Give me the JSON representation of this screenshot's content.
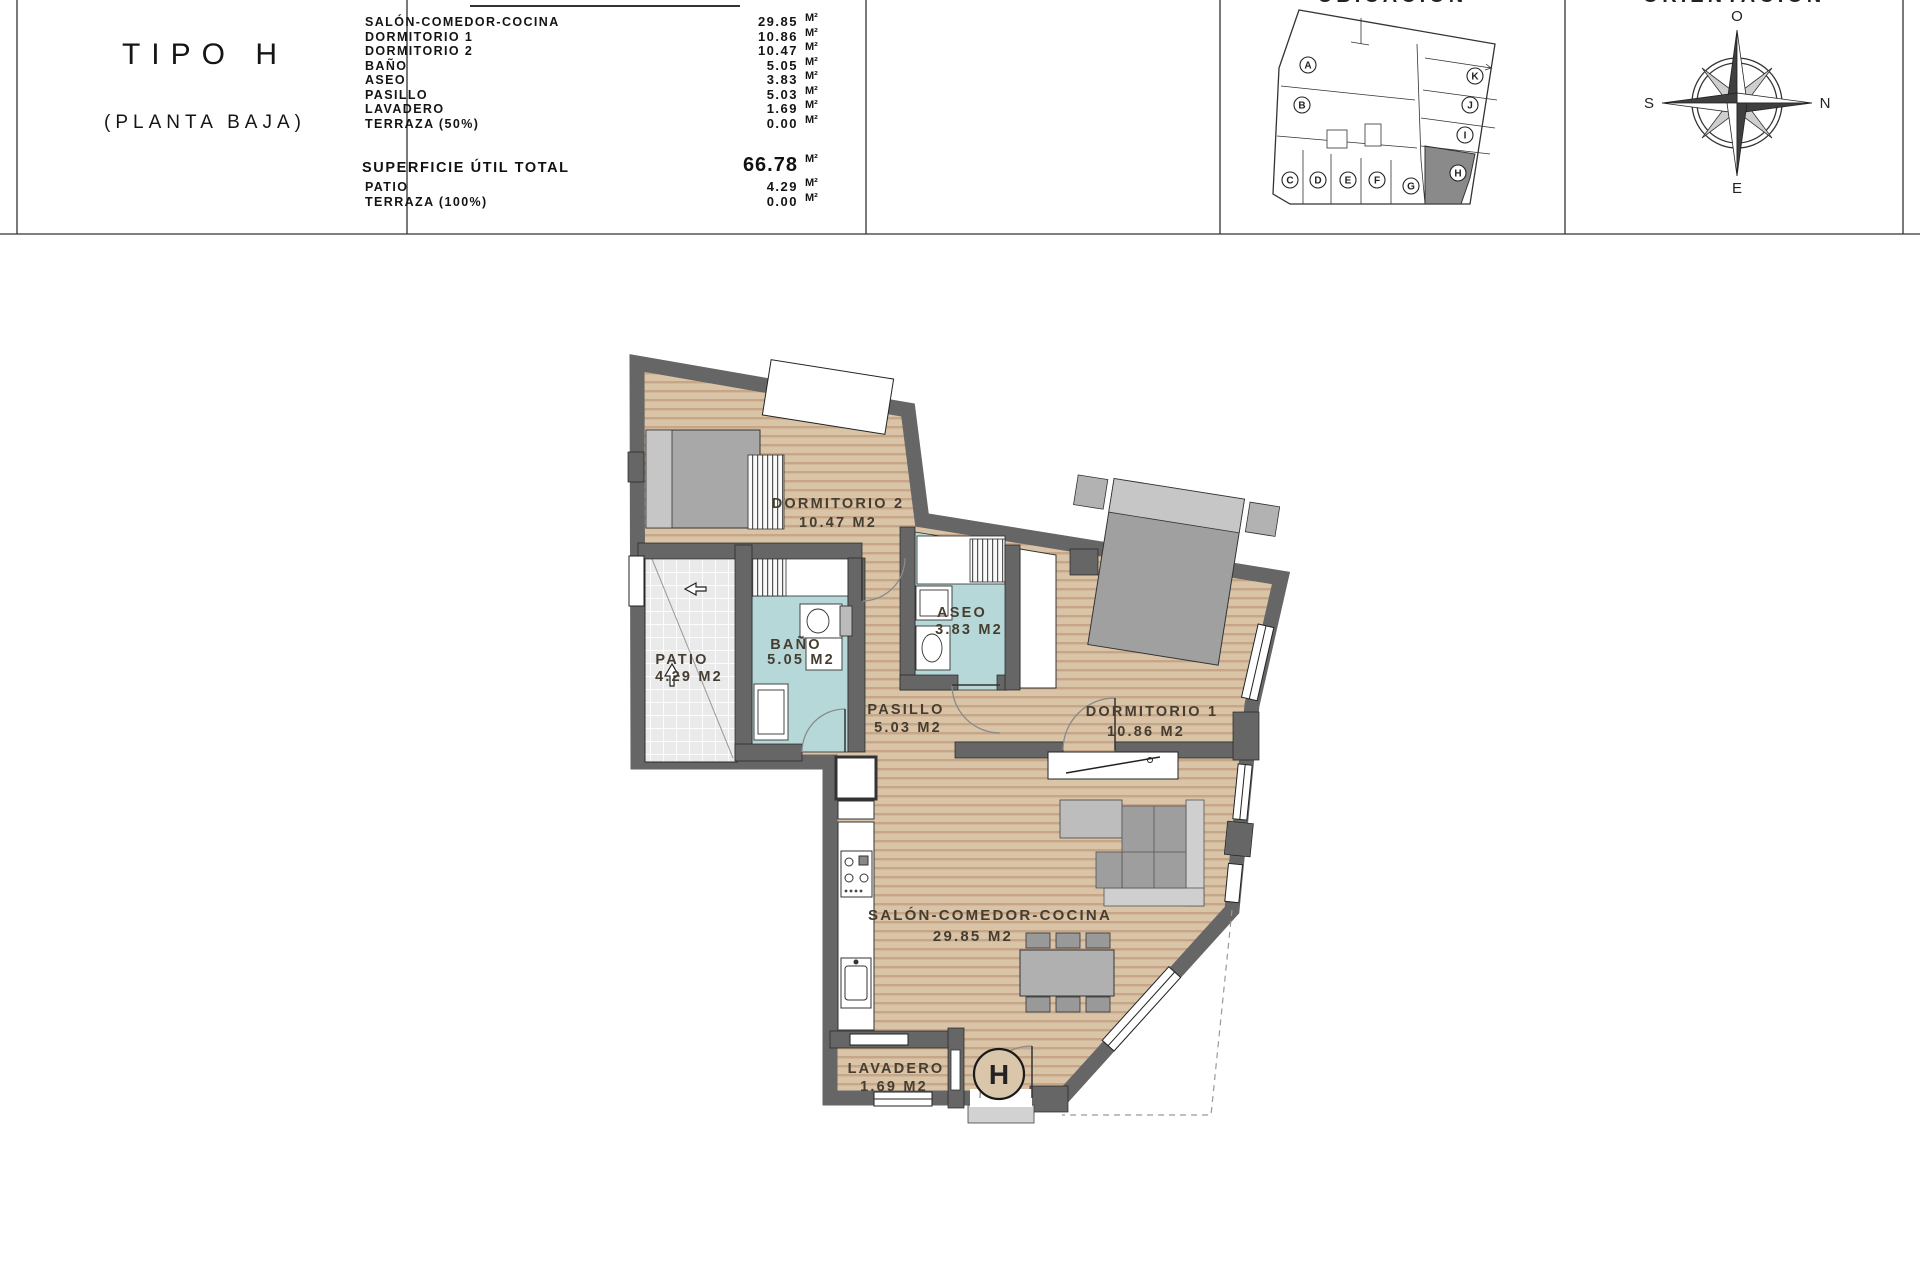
{
  "title_block": {
    "line1": "TIPO H",
    "line2": "(PLANTA BAJA)"
  },
  "area_table": {
    "rows": [
      {
        "label": "SALÓN-COMEDOR-COCINA",
        "value": "29.85",
        "unit": "M²"
      },
      {
        "label": "DORMITORIO 1",
        "value": "10.86",
        "unit": "M²"
      },
      {
        "label": "DORMITORIO 2",
        "value": "10.47",
        "unit": "M²"
      },
      {
        "label": "BAÑO",
        "value": "5.05",
        "unit": "M²"
      },
      {
        "label": "ASEO",
        "value": "3.83",
        "unit": "M²"
      },
      {
        "label": "PASILLO",
        "value": "5.03",
        "unit": "M²"
      },
      {
        "label": "LAVADERO",
        "value": "1.69",
        "unit": "M²"
      },
      {
        "label": "TERRAZA (50%)",
        "value": "0.00",
        "unit": "M²"
      }
    ],
    "total": {
      "label": "SUPERFICIE ÚTIL TOTAL",
      "value": "66.78",
      "unit": "M²"
    },
    "extra_rows": [
      {
        "label": "PATIO",
        "value": "4.29",
        "unit": "M²"
      },
      {
        "label": "TERRAZA (100%)",
        "value": "0.00",
        "unit": "M²"
      }
    ]
  },
  "section_headers": {
    "ubicacion": "UBICACIÓN",
    "orientacion": "ORIENTACIÓN"
  },
  "location_map": {
    "units": [
      "A",
      "B",
      "C",
      "D",
      "E",
      "F",
      "G",
      "H",
      "I",
      "J",
      "K"
    ],
    "highlighted_unit": "H"
  },
  "compass": {
    "top": "O",
    "right": "N",
    "left": "S",
    "bottom": "E"
  },
  "floor_plan": {
    "rooms": [
      {
        "name": "DORMITORIO 2",
        "area": "10.47 M2"
      },
      {
        "name": "BAÑO",
        "area": "5.05 M2"
      },
      {
        "name": "ASEO",
        "area": "3.83 M2"
      },
      {
        "name": "PATIO",
        "area": "4.29 M2"
      },
      {
        "name": "PASILLO",
        "area": "5.03 M2"
      },
      {
        "name": "DORMITORIO 1",
        "area": "10.86 M2"
      },
      {
        "name": "SALÓN-COMEDOR-COCINA",
        "area": "29.85 M2"
      },
      {
        "name": "LAVADERO",
        "area": "1.69 M2"
      }
    ],
    "entrance_marker": "H"
  },
  "colors": {
    "wall": "#666666",
    "wood": "#d9c4a8",
    "wood_stripe": "#c6a687",
    "wet_room": "#b7d8d8",
    "patio_tile": "#eaeaea",
    "furniture": "#a0a0a0"
  }
}
